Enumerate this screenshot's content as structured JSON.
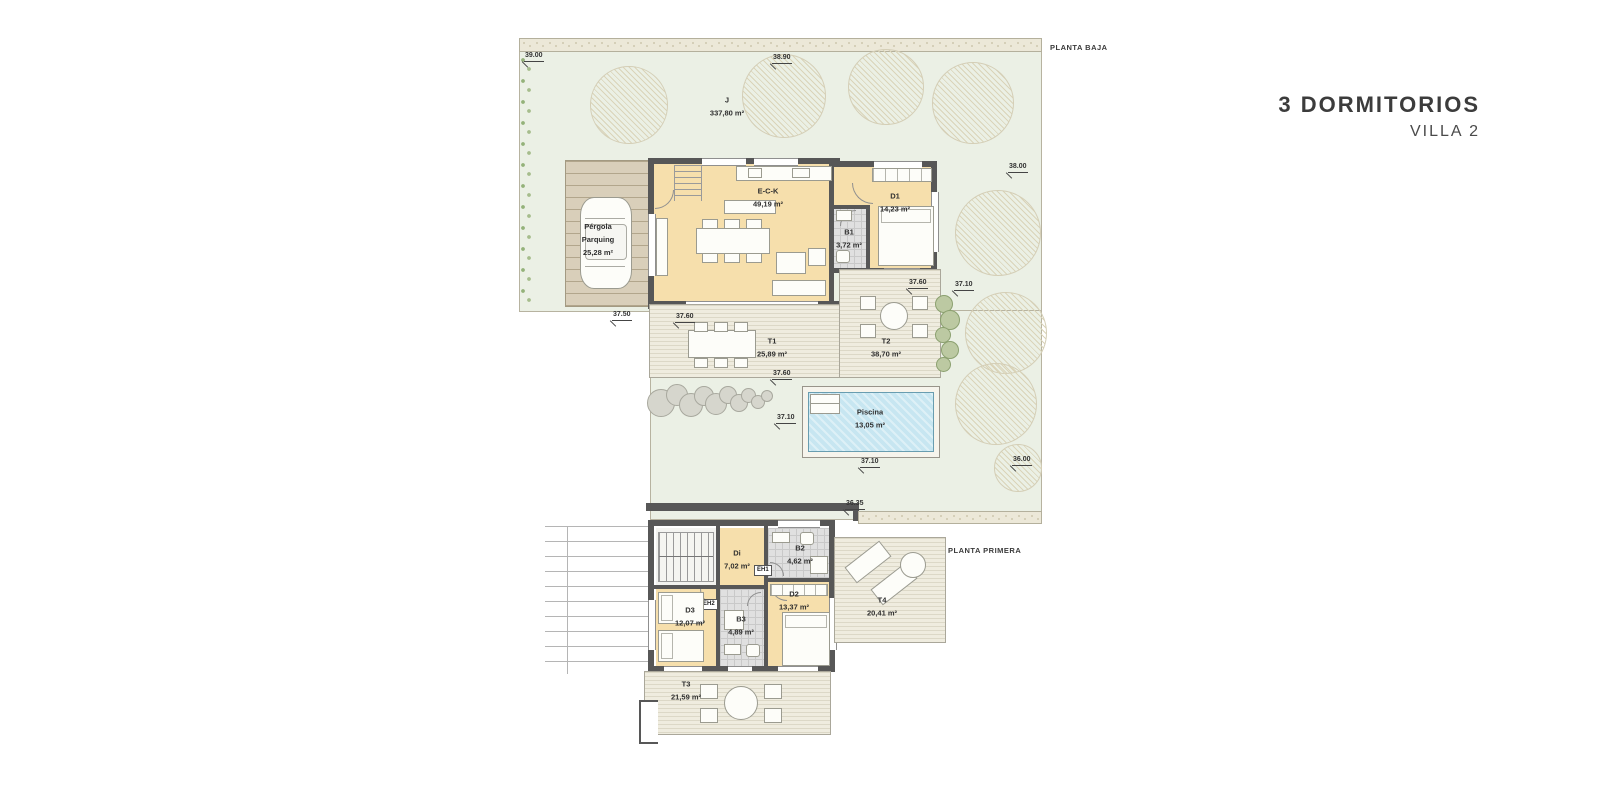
{
  "header": {
    "title": "3 DORMITORIOS",
    "subtitle": "VILLA 2"
  },
  "floors": {
    "baja": {
      "label": "PLANTA BAJA",
      "rooms": {
        "garden": {
          "name": "J",
          "area": "337,80 m²"
        },
        "pergola": {
          "line1": "Pérgola",
          "line2": "Parquing",
          "area": "25,28 m²"
        },
        "eck": {
          "name": "E-C-K",
          "area": "49,19 m²"
        },
        "b1": {
          "name": "B1",
          "area": "3,72 m²"
        },
        "d1": {
          "name": "D1",
          "area": "14,23 m²"
        },
        "t1": {
          "name": "T1",
          "area": "25,89 m²"
        },
        "t2": {
          "name": "T2",
          "area": "38,70 m²"
        },
        "pool": {
          "name": "Piscina",
          "area": "13,05 m²"
        }
      },
      "dimensions": [
        {
          "text": "39.00"
        },
        {
          "text": "38.90"
        },
        {
          "text": "38.00"
        },
        {
          "text": "37.60"
        },
        {
          "text": "37.10"
        },
        {
          "text": "37.50"
        },
        {
          "text": "37.60"
        },
        {
          "text": "37.60"
        },
        {
          "text": "37.10"
        },
        {
          "text": "37.10"
        },
        {
          "text": "36.00"
        },
        {
          "text": "36.35"
        }
      ]
    },
    "primera": {
      "label": "PLANTA PRIMERA",
      "rooms": {
        "di": {
          "name": "Di",
          "area": "7,02 m²"
        },
        "b2": {
          "name": "B2",
          "area": "4,62 m²"
        },
        "d2": {
          "name": "D2",
          "area": "13,37 m²"
        },
        "d3": {
          "name": "D3",
          "area": "12,07 m²"
        },
        "b3": {
          "name": "B3",
          "area": "4,89 m²"
        },
        "t4": {
          "name": "T4",
          "area": "20,41 m²"
        },
        "t3": {
          "name": "T3",
          "area": "21,59 m²"
        },
        "eh1": {
          "name": "EH1"
        },
        "eh2": {
          "name": "EH2"
        }
      }
    }
  },
  "colors": {
    "room_cream": "#f6dfac",
    "plot_green": "#ebf0e5",
    "wall_gray": "#575757",
    "pool_blue": "#c7e6f1",
    "deck_beige": "#efecdf",
    "pergola_tan": "#d9cfba",
    "title_gray": "#3c3c3c"
  }
}
